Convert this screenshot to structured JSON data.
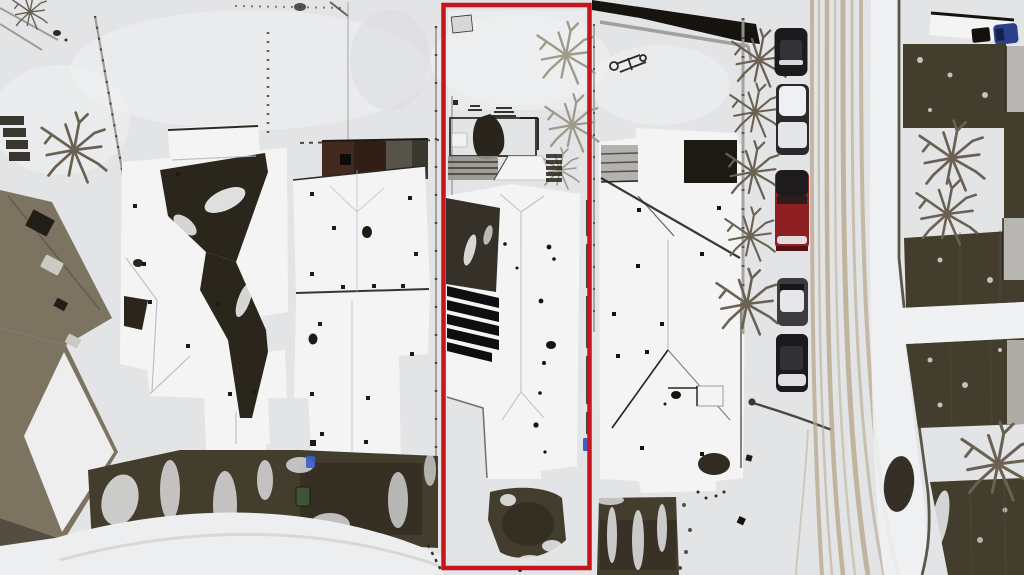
{
  "scene": {
    "kind": "aerial-drone-photo",
    "season": "winter-snow",
    "subject": "snow-covered townhouse lots, one property outlined in red, parked cars and street at right"
  },
  "colors": {
    "snow": "#e3e4e6",
    "snow_bright": "#f0f1f2",
    "roof_white": "#f4f4f5",
    "roof_shadow": "#b9bac0",
    "ground_dark": "#433d2d",
    "ground_darker": "#2b271d",
    "roof_bare": "#2b261c",
    "solar": "#0e0e0f",
    "olive_roof": "#7c7460",
    "skylight": "#cbcac2",
    "fence": "#9c9c9a",
    "shed_brick": "#44291f",
    "shed_gray": "#56534b",
    "deck": "#2a251c",
    "tree": "#6b6152",
    "tree_light": "#98917f",
    "road_track": "#b7a78c",
    "curb": "#4d4639",
    "lamp": "#4a463c",
    "car_black": "#1b1b1d",
    "car_dark": "#2a2a2c",
    "car_red": "#8e2024",
    "car_gray": "#3b3c3e",
    "car_blue": "#2b3f8a",
    "bin_blue": "#3d5fc4",
    "box_green": "#3e5434",
    "car_snow": "#eef0f1"
  },
  "lot": {
    "x": 443.5,
    "y": 5,
    "width": 146,
    "height": 563,
    "border_width": 4.5,
    "border_color": "#c8151b"
  },
  "objects": {
    "parked_cars_right_column": [
      {
        "name": "black-suv"
      },
      {
        "name": "snow-covered-car"
      },
      {
        "name": "red-suv"
      },
      {
        "name": "gray-car"
      },
      {
        "name": "black-sedan"
      }
    ],
    "vehicle_top_right": {
      "name": "blue-vehicle"
    },
    "street_lamp_count": 1,
    "fence_line_trees": 5,
    "right_lawn_trees": 3,
    "houses_visible": 5
  }
}
